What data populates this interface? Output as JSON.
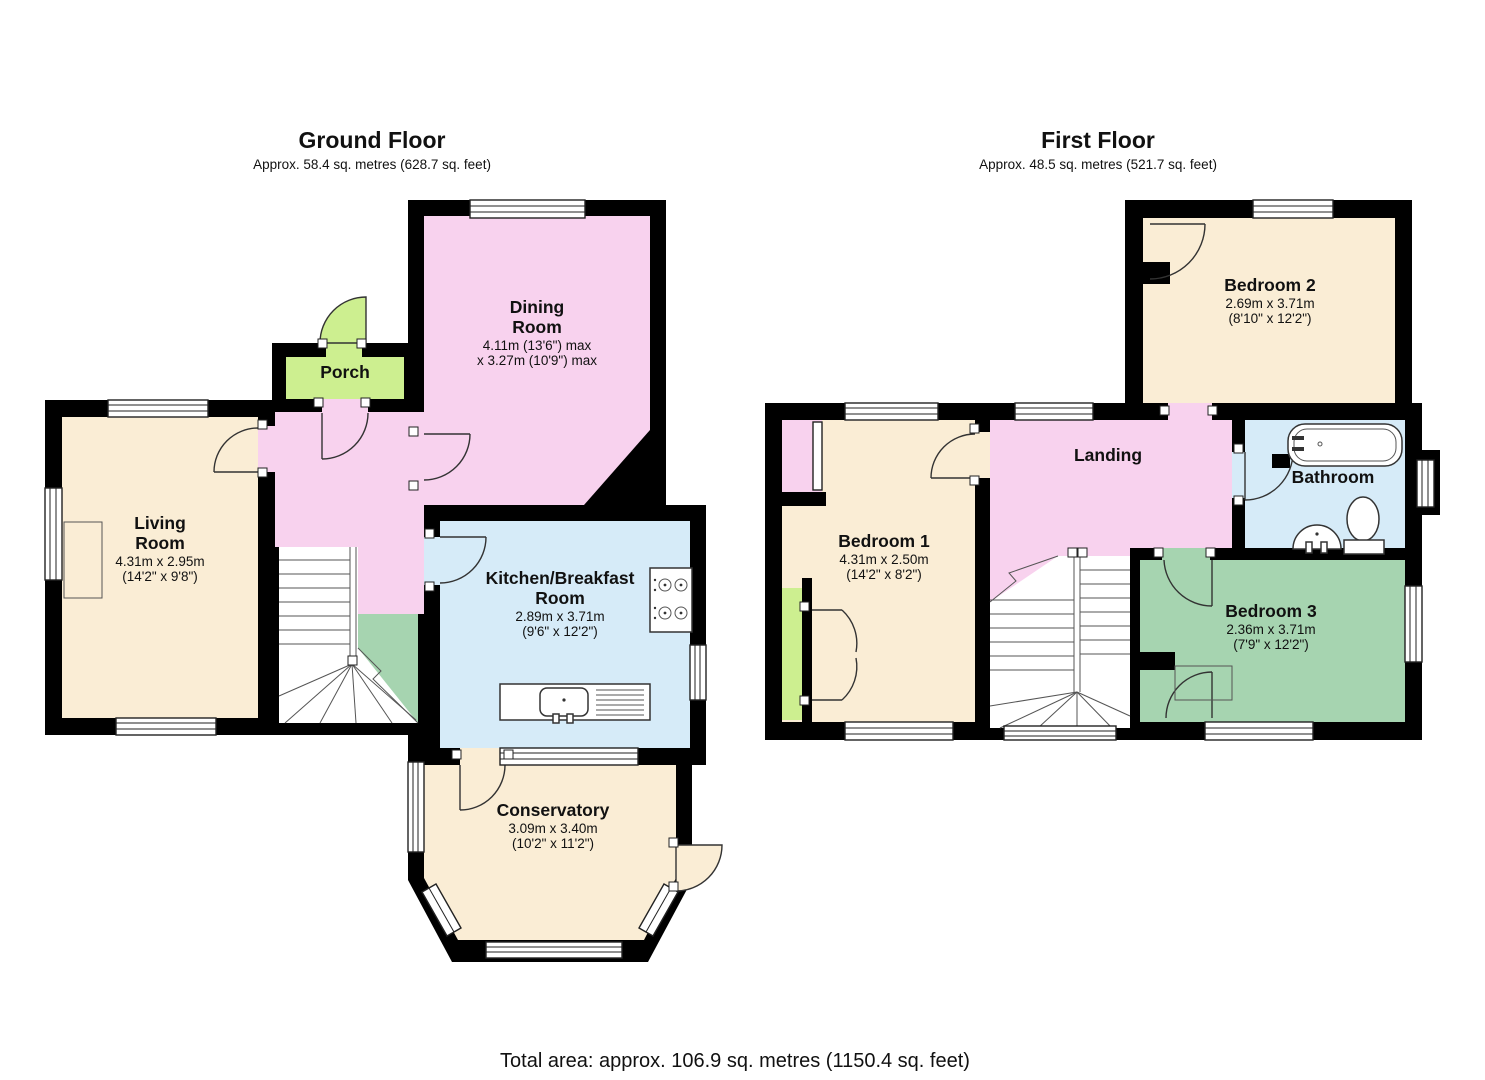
{
  "palette": {
    "wall": "#000000",
    "room_cream": "#FAEDD5",
    "room_pink": "#F8D2EE",
    "room_green": "#CDEF90",
    "room_blue": "#D6EBF8",
    "room_sage": "#A6D4B0"
  },
  "ground_floor": {
    "title": "Ground Floor",
    "subtitle": "Approx. 58.4 sq. metres (628.7 sq. feet)",
    "rooms": {
      "dining": {
        "name_line1": "Dining",
        "name_line2": "Room",
        "dim1": "4.11m (13'6\") max",
        "dim2": "x 3.27m (10'9\") max"
      },
      "porch": {
        "name": "Porch"
      },
      "living": {
        "name_line1": "Living",
        "name_line2": "Room",
        "dim1": "4.31m x 2.95m",
        "dim2": "(14'2\" x 9'8\")"
      },
      "kitchen": {
        "name_line1": "Kitchen/Breakfast",
        "name_line2": "Room",
        "dim1": "2.89m x 3.71m",
        "dim2": "(9'6\" x 12'2\")"
      },
      "conservatory": {
        "name": "Conservatory",
        "dim1": "3.09m x 3.40m",
        "dim2": "(10'2\" x 11'2\")"
      }
    }
  },
  "first_floor": {
    "title": "First Floor",
    "subtitle": "Approx. 48.5 sq. metres (521.7 sq. feet)",
    "rooms": {
      "bedroom2": {
        "name": "Bedroom 2",
        "dim1": "2.69m x 3.71m",
        "dim2": "(8'10\" x 12'2\")"
      },
      "landing": {
        "name": "Landing"
      },
      "bathroom": {
        "name": "Bathroom"
      },
      "bedroom1": {
        "name": "Bedroom 1",
        "dim1": "4.31m x 2.50m",
        "dim2": "(14'2\" x 8'2\")"
      },
      "bedroom3": {
        "name": "Bedroom 3",
        "dim1": "2.36m x 3.71m",
        "dim2": "(7'9\" x 12'2\")"
      }
    }
  },
  "footer": {
    "total_area": "Total area: approx. 106.9 sq. metres (1150.4 sq. feet)"
  }
}
